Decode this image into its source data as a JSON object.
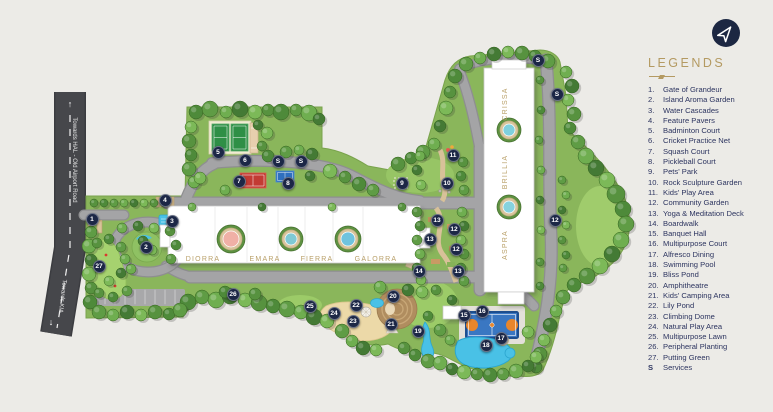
{
  "legend": {
    "title": "LEGENDS",
    "items": [
      {
        "num": "1.",
        "label": "Gate of Grandeur"
      },
      {
        "num": "2.",
        "label": "Island Aroma Garden"
      },
      {
        "num": "3.",
        "label": "Water Cascades"
      },
      {
        "num": "4.",
        "label": "Feature Pavers"
      },
      {
        "num": "5.",
        "label": "Badminton Court"
      },
      {
        "num": "6.",
        "label": "Cricket Practice Net"
      },
      {
        "num": "7.",
        "label": "Squash Court"
      },
      {
        "num": "8.",
        "label": "Pickleball Court"
      },
      {
        "num": "9.",
        "label": "Pets' Park"
      },
      {
        "num": "10.",
        "label": "Rock Sculpture Garden"
      },
      {
        "num": "11.",
        "label": "Kids' Play Area"
      },
      {
        "num": "12.",
        "label": "Community Garden"
      },
      {
        "num": "13.",
        "label": "Yoga & Meditation Deck"
      },
      {
        "num": "14.",
        "label": "Boardwalk"
      },
      {
        "num": "15.",
        "label": "Banquet Hall"
      },
      {
        "num": "16.",
        "label": "Multipurpose Court"
      },
      {
        "num": "17.",
        "label": "Alfresco Dining"
      },
      {
        "num": "18.",
        "label": "Swimming Pool"
      },
      {
        "num": "19.",
        "label": "Bliss Pond"
      },
      {
        "num": "20.",
        "label": "Amphitheatre"
      },
      {
        "num": "21.",
        "label": "Kids' Camping Area"
      },
      {
        "num": "22.",
        "label": "Lily Pond"
      },
      {
        "num": "23.",
        "label": "Climbing Dome"
      },
      {
        "num": "24.",
        "label": "Natural Play Area"
      },
      {
        "num": "25.",
        "label": "Multipurpose Lawn"
      },
      {
        "num": "26.",
        "label": "Peripheral Planting"
      },
      {
        "num": "27.",
        "label": "Putting Green"
      },
      {
        "num": "S",
        "label": "Services"
      }
    ]
  },
  "roads": {
    "top_label": "Towards HAL - Old Airport Road",
    "top_arrow": "↑",
    "bottom_label": "Towards KIA",
    "bottom_arrow": "↓"
  },
  "towers_row": [
    "DIORRA",
    "EMARA",
    "FIERRA",
    "GALORRA"
  ],
  "towers_right": [
    "CRISSA",
    "BRILLIA",
    "ASPRA"
  ],
  "markers": [
    {
      "n": "1",
      "x": 92,
      "y": 219
    },
    {
      "n": "2",
      "x": 146,
      "y": 247
    },
    {
      "n": "3",
      "x": 172,
      "y": 221
    },
    {
      "n": "4",
      "x": 165,
      "y": 200
    },
    {
      "n": "5",
      "x": 218,
      "y": 152
    },
    {
      "n": "6",
      "x": 245,
      "y": 160
    },
    {
      "n": "S",
      "x": 278,
      "y": 161
    },
    {
      "n": "S",
      "x": 301,
      "y": 161
    },
    {
      "n": "7",
      "x": 239,
      "y": 181
    },
    {
      "n": "8",
      "x": 288,
      "y": 183
    },
    {
      "n": "9",
      "x": 402,
      "y": 183
    },
    {
      "n": "10",
      "x": 447,
      "y": 183
    },
    {
      "n": "11",
      "x": 453,
      "y": 155
    },
    {
      "n": "13",
      "x": 437,
      "y": 220
    },
    {
      "n": "12",
      "x": 454,
      "y": 229
    },
    {
      "n": "13",
      "x": 430,
      "y": 239
    },
    {
      "n": "12",
      "x": 456,
      "y": 249
    },
    {
      "n": "14",
      "x": 419,
      "y": 271
    },
    {
      "n": "13",
      "x": 458,
      "y": 271
    },
    {
      "n": "12",
      "x": 555,
      "y": 220
    },
    {
      "n": "S",
      "x": 538,
      "y": 60
    },
    {
      "n": "S",
      "x": 557,
      "y": 94
    },
    {
      "n": "15",
      "x": 464,
      "y": 315
    },
    {
      "n": "16",
      "x": 482,
      "y": 311
    },
    {
      "n": "17",
      "x": 501,
      "y": 338
    },
    {
      "n": "18",
      "x": 486,
      "y": 345
    },
    {
      "n": "19",
      "x": 418,
      "y": 331
    },
    {
      "n": "20",
      "x": 393,
      "y": 296
    },
    {
      "n": "21",
      "x": 391,
      "y": 324
    },
    {
      "n": "22",
      "x": 356,
      "y": 305
    },
    {
      "n": "23",
      "x": 353,
      "y": 321
    },
    {
      "n": "24",
      "x": 334,
      "y": 313
    },
    {
      "n": "25",
      "x": 310,
      "y": 306
    },
    {
      "n": "26",
      "x": 233,
      "y": 294
    },
    {
      "n": "27",
      "x": 99,
      "y": 266
    }
  ],
  "colors": {
    "marker_navy": "#1c2746",
    "legend_gold": "#b49a62",
    "legend_text": "#2d3560",
    "site_green": "#8ab65b",
    "water_blue": "#49c1e6",
    "road_gray": "#a2a2a4"
  }
}
